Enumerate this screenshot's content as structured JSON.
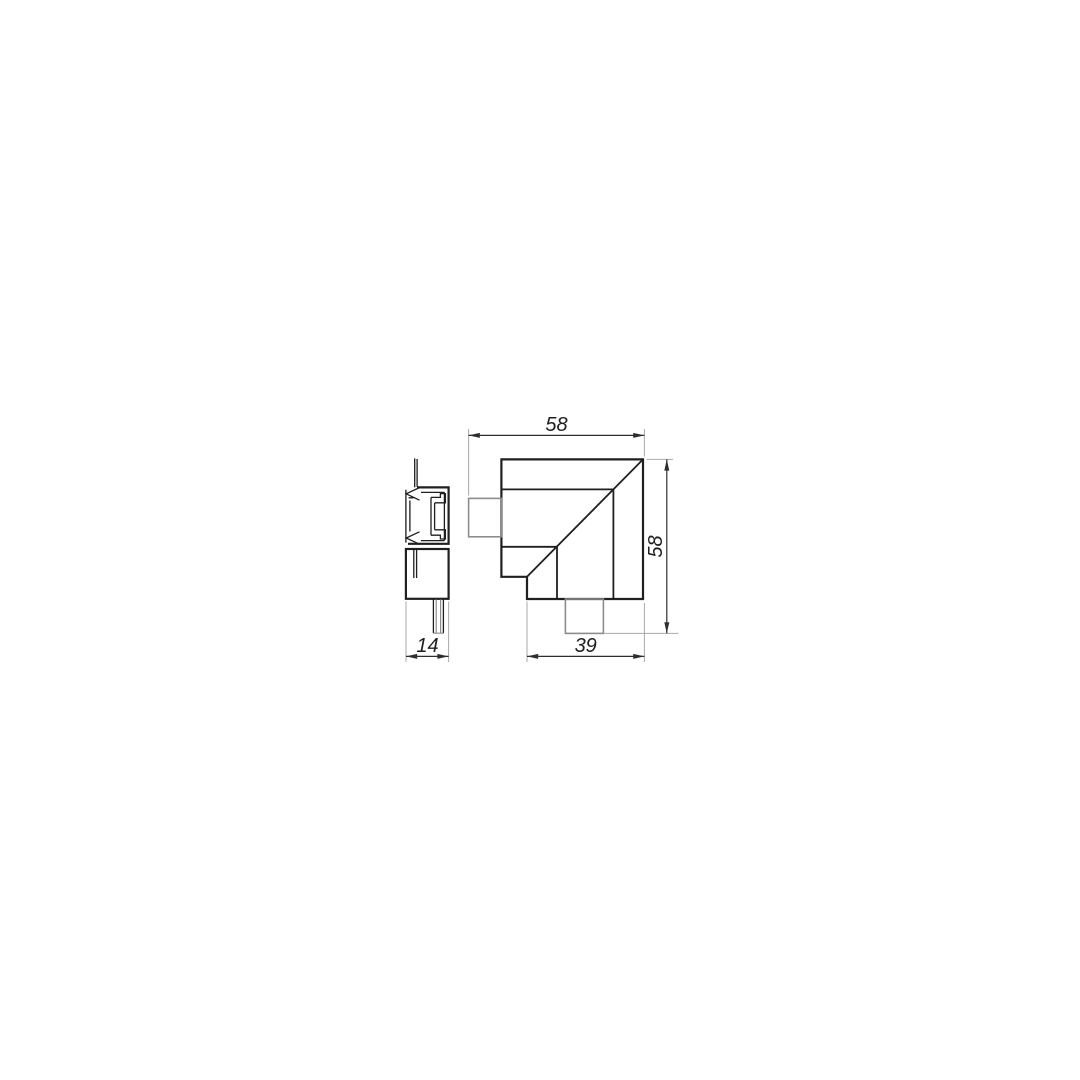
{
  "drawing": {
    "dimensions": {
      "top_width": "58",
      "right_height": "58",
      "bottom_width": "39",
      "side_width": "14"
    },
    "colors": {
      "background": "#ffffff",
      "line_main": "#1f1f1f",
      "line_secondary": "#8c8c8c",
      "line_dimension": "#2e2e2e",
      "line_extension": "#a9a9a9",
      "text": "#1f1f1f"
    }
  }
}
